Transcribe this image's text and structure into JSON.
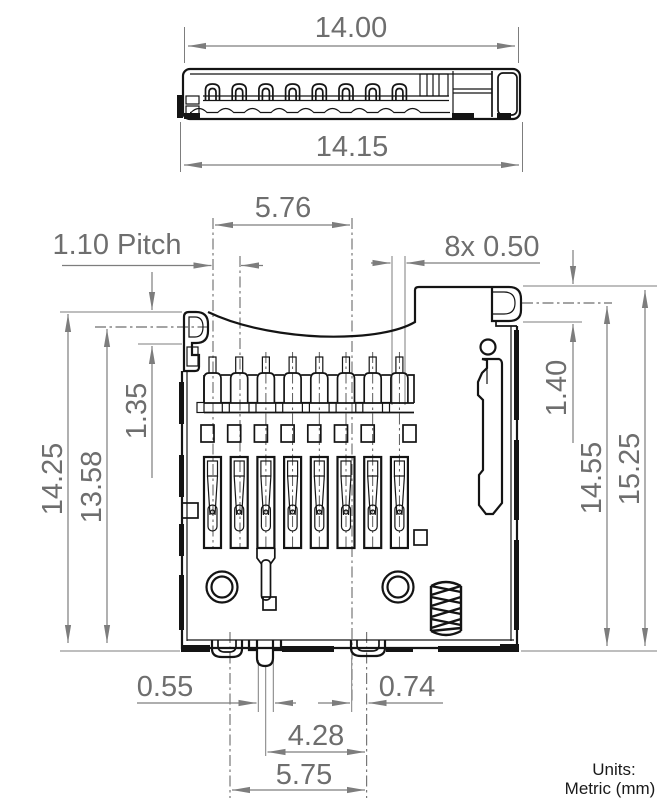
{
  "drawing": {
    "type": "microSD card connector technical drawing",
    "units": {
      "label": "Units:",
      "value": "Metric (mm)"
    },
    "side_view": {
      "name": "connector side profile view",
      "dim_width_top": "14.00",
      "dim_width_bottom": "14.15"
    },
    "front_view": {
      "name": "connector top view",
      "dim_contact_span": "5.76",
      "dim_pitch": "1.10 Pitch",
      "dim_contact_width": "8x 0.50",
      "dim_height_outer_left": "14.25",
      "dim_height_inner_left": "13.58",
      "dim_ear_height": "1.35",
      "dim_tab_height": "1.40",
      "dim_height_inner_right": "14.55",
      "dim_height_outer_right": "15.25",
      "dim_small_peg_width": "0.55",
      "dim_right_peg_width": "0.74",
      "dim_peg_span_inner": "4.28",
      "dim_peg_span_outer": "5.75"
    },
    "colors": {
      "geometry_line": "#141414",
      "dimension_line": "#7d7d7d",
      "dimension_text": "#6e6e6e",
      "units_text": "#1a1a1a",
      "background": "#ffffff"
    }
  }
}
